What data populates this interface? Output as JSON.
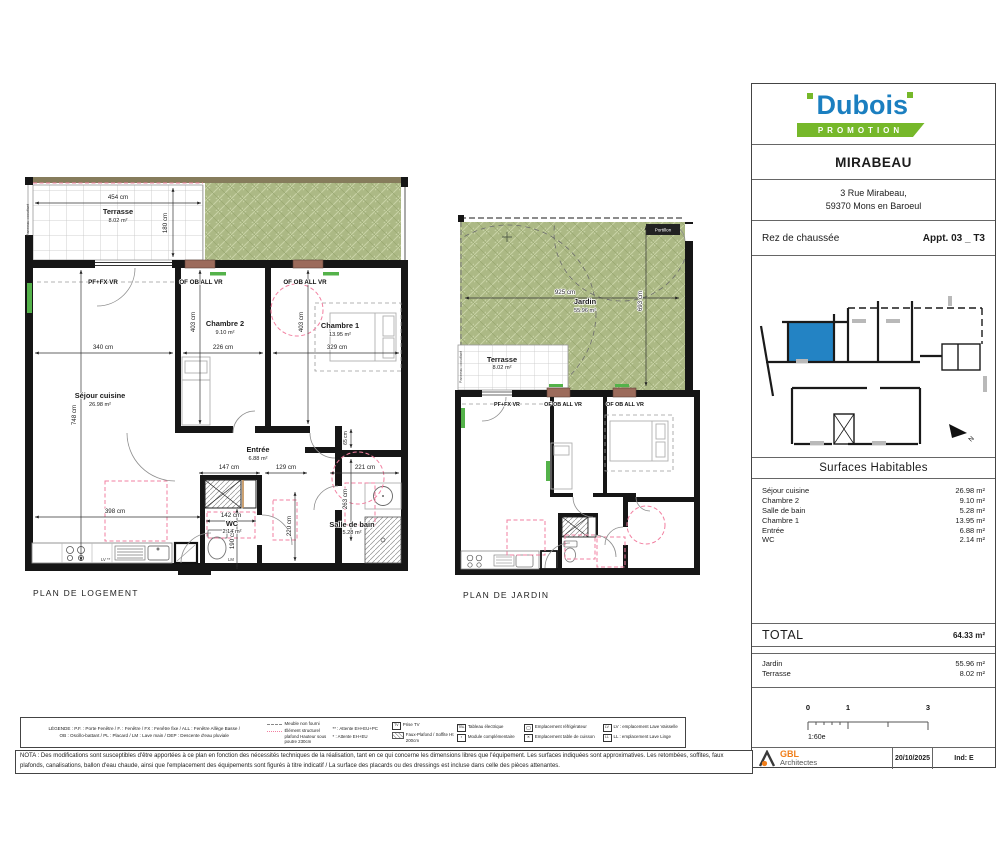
{
  "colors": {
    "brand_blue": "#1B7FC0",
    "brand_green": "#76B82A",
    "plan_green": "#ACB985",
    "window_sill_terracotta": "#9C6B5B",
    "unit_highlight_blue": "#2383C4",
    "accent_pink": "#F27FA0",
    "gbl_orange": "#F07E1A"
  },
  "plans": {
    "logement": {
      "caption": "PLAN DE LOGEMENT",
      "rooms": {
        "terrasse": {
          "name": "Terrasse",
          "area": "8.02 m²"
        },
        "sejour": {
          "name": "Séjour cuisine",
          "area": "26.98 m²"
        },
        "chambre2": {
          "name": "Chambre 2",
          "area": "9.10 m²"
        },
        "chambre1": {
          "name": "Chambre 1",
          "area": "13.95 m²"
        },
        "entree": {
          "name": "Entrée",
          "area": "6.88 m²"
        },
        "wc": {
          "name": "WC",
          "area": "2.14 m²"
        },
        "sdb": {
          "name": "Salle de bain",
          "area": "5.28 m²"
        }
      },
      "window_labels": [
        "PF+FX VR",
        "OF OB ALL VR",
        "OF OB ALL VR"
      ],
      "dims": [
        "454 cm",
        "180 cm",
        "340 cm",
        "748 cm",
        "398 cm",
        "403 cm",
        "226 cm",
        "403 cm",
        "329 cm",
        "147 cm",
        "129 cm",
        "221 cm",
        "142 cm",
        "190 cm",
        "220 cm",
        "263 cm",
        "65 cm"
      ],
      "annotations": {
        "panneau": "Panneau occultant",
        "lv": "LV **",
        "lm": "LM"
      }
    },
    "jardin": {
      "caption": "PLAN DE JARDIN",
      "rooms": {
        "jardin": {
          "name": "Jardin",
          "area": "55.96 m²"
        },
        "terrasse": {
          "name": "Terrasse",
          "area": "8.02 m²"
        }
      },
      "window_labels": [
        "PF+FX VR",
        "OF OB ALL VR",
        "OF OB ALL VR"
      ],
      "dims": [
        "925 cm",
        "693 cm"
      ],
      "annotations": {
        "panneau": "Panneau occultant",
        "portillon": "Portillon"
      }
    }
  },
  "title_block": {
    "brand": {
      "name": "Dubois",
      "tagline": "PROMOTION"
    },
    "project": "MIRABEAU",
    "address": [
      "3 Rue Mirabeau,",
      "59370 Mons en Baroeul"
    ],
    "level": "Rez de chaussée",
    "apartment": "Appt. 03 _ T3",
    "north_label": "N",
    "surfaces": {
      "title": "Surfaces Habitables",
      "rows": [
        {
          "label": "Séjour cuisine",
          "value": "26.98 m²"
        },
        {
          "label": "Chambre 2",
          "value": "9.10 m²"
        },
        {
          "label": "Salle de bain",
          "value": "5.28 m²"
        },
        {
          "label": "Chambre 1",
          "value": "13.95 m²"
        },
        {
          "label": "Entrée",
          "value": "6.88 m²"
        },
        {
          "label": "WC",
          "value": "2.14 m²"
        }
      ],
      "total_label": "TOTAL",
      "total_value": "64.33 m²",
      "outdoor_rows": [
        {
          "label": "Jardin",
          "value": "55.96 m²"
        },
        {
          "label": "Terrasse",
          "value": "8.02 m²"
        }
      ]
    },
    "scale": {
      "ticks": [
        "0",
        "1",
        "3"
      ],
      "ratio": "1:60e"
    },
    "architect": {
      "name": "GBL",
      "subtitle": "Architectes"
    },
    "date": "20/10/2025",
    "revision": "Ind: E"
  },
  "legend": {
    "intro_line1": "LÉGENDE : P.F. : Porte Fenêtre / F. : Fenêtre / FX : Fenêtre fixe / ALL : Fenêtre Allège Basse /",
    "intro_line2": "OB : Oscillo-battant / PL : Placard / LM : Lave main / DEP : Descente d'eau pluviale",
    "items": [
      {
        "glyph": "",
        "label": "Meuble non fourni"
      },
      {
        "glyph": "",
        "label": "Élément structurel plafond Hauteur sous poutre 230cm"
      },
      {
        "glyph": "",
        "label": "** : Attente EH+EU+PC"
      },
      {
        "glyph": "",
        "label": "* : Attente EH+EU"
      },
      {
        "glyph": "TV",
        "label": "Prise TV"
      },
      {
        "glyph": "",
        "label": "Faux-Plafond / Soffite Ht 200cm"
      },
      {
        "glyph": "TBL",
        "label": "Tableau électrique"
      },
      {
        "glyph": "▪",
        "label": "Module complémentaire"
      },
      {
        "glyph": "",
        "label": "Emplacement réfrigérateur"
      },
      {
        "glyph": "✕",
        "label": "Emplacement table de cuisson"
      },
      {
        "glyph": "LV",
        "label": "LV : emplacement Lave Vaisselle"
      },
      {
        "glyph": "LL",
        "label": "LL : emplacement Lave Linge"
      }
    ]
  },
  "nota": "NOTA : Des modifications sont susceptibles d'être apportées à ce plan en fonction des nécessités techniques de la réalisation, tant en ce qui concerne les dimensions libres que l'équipement. Les surfaces indiquées sont approximatives. Les retombées, soffites, faux plafonds, canalisations, ballon d'eau chaude, ainsi que l'emplacement des équipements sont figurés à titre indicatif / La surface des placards ou des dressings est incluse dans celle des pièces attenantes."
}
